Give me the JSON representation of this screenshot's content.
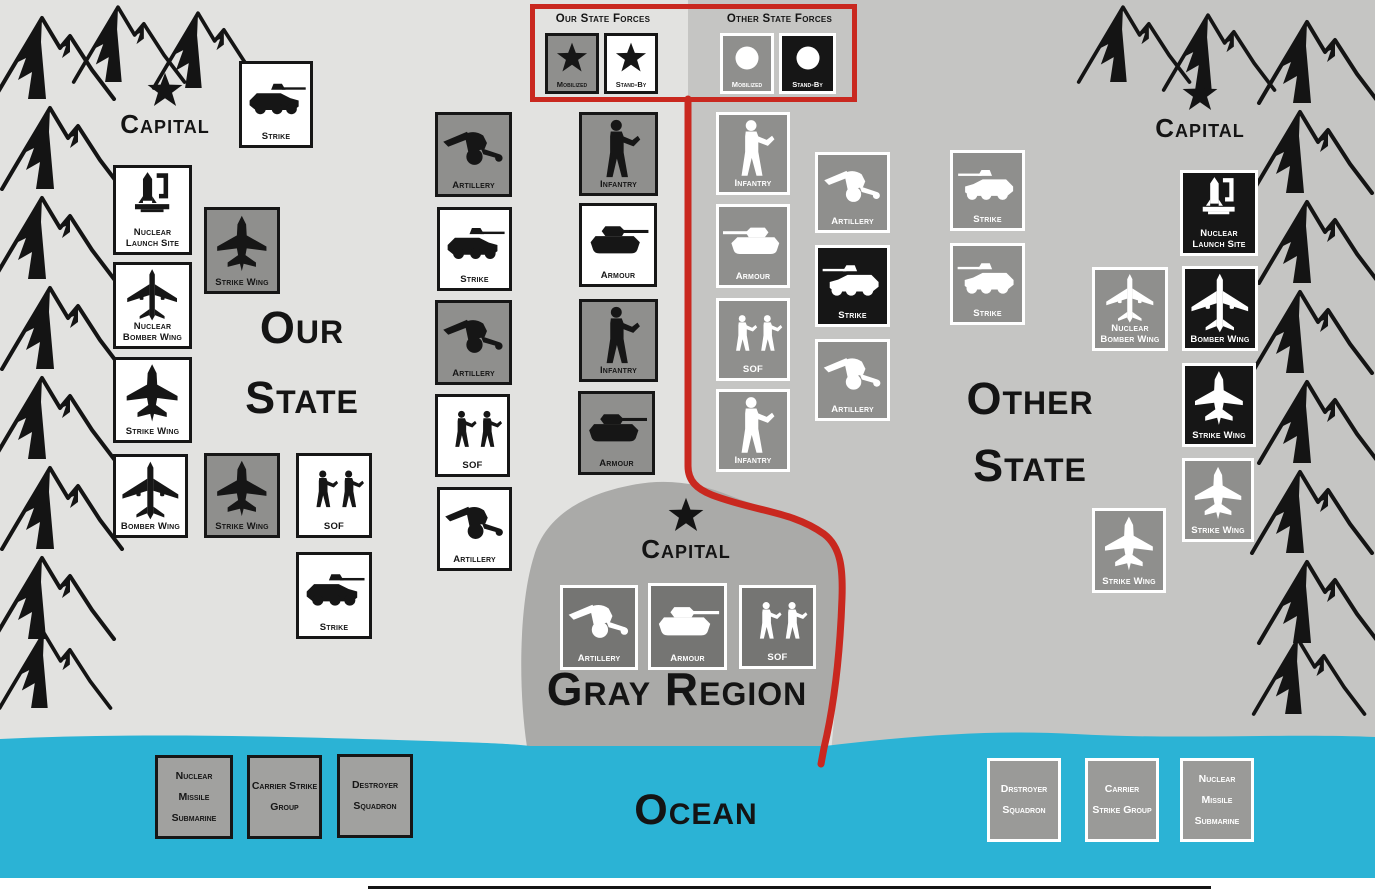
{
  "legend": {
    "our": {
      "title": "Our State Forces",
      "items": [
        {
          "label": "Mobilized"
        },
        {
          "label": "Stand-By"
        }
      ]
    },
    "other": {
      "title": "Other State Forces",
      "items": [
        {
          "label": "Mobilized"
        },
        {
          "label": "Stand-By"
        }
      ]
    }
  },
  "regions": {
    "our_state": {
      "name": "Our State",
      "capital_label": "Capital"
    },
    "other_state": {
      "name": "Other State",
      "capital_label": "Capital"
    },
    "gray_region": {
      "name": "Gray Region",
      "capital_label": "Capital"
    },
    "ocean": {
      "name": "Ocean"
    }
  },
  "colors": {
    "boundary_red": "#c9281f",
    "ocean_cyan": "#2bb3d5",
    "our_state_bg": "#e2e2e0",
    "other_state_bg": "#c5c5c3",
    "gray_region_bg": "#aaaaa8",
    "unit_gray": "#8f8f8d",
    "unit_black": "#161616",
    "unit_white": "#ffffff"
  },
  "capitals": [
    {
      "region": "our_state",
      "x": 100,
      "y": 72,
      "w": 130
    },
    {
      "region": "other_state",
      "x": 1135,
      "y": 76,
      "w": 130
    },
    {
      "region": "gray_region",
      "x": 620,
      "y": 497,
      "w": 132
    }
  ],
  "units": [
    {
      "label": "Strike",
      "icon": "strike",
      "variant": "our-standby",
      "x": 239,
      "y": 61,
      "w": 74,
      "h": 87
    },
    {
      "label": "Nuclear\nLaunch Site",
      "icon": "nuclear-launch",
      "variant": "our-standby",
      "x": 113,
      "y": 165,
      "w": 79,
      "h": 90
    },
    {
      "label": "Strike Wing",
      "icon": "strike-wing",
      "variant": "our-mobilized",
      "x": 204,
      "y": 207,
      "w": 76,
      "h": 87
    },
    {
      "label": "Nuclear\nBomber Wing",
      "icon": "bomber-wing",
      "variant": "our-standby",
      "x": 113,
      "y": 262,
      "w": 79,
      "h": 87
    },
    {
      "label": "Strike Wing",
      "icon": "strike-wing",
      "variant": "our-standby",
      "x": 113,
      "y": 357,
      "w": 79,
      "h": 86
    },
    {
      "label": "Bomber Wing",
      "icon": "bomber-wing",
      "variant": "our-standby",
      "x": 113,
      "y": 454,
      "w": 75,
      "h": 84
    },
    {
      "label": "Strike Wing",
      "icon": "strike-wing",
      "variant": "our-mobilized",
      "x": 204,
      "y": 453,
      "w": 76,
      "h": 85
    },
    {
      "label": "SOF",
      "icon": "sof",
      "variant": "our-standby",
      "x": 296,
      "y": 453,
      "w": 76,
      "h": 85
    },
    {
      "label": "Strike",
      "icon": "strike",
      "variant": "our-standby",
      "x": 296,
      "y": 552,
      "w": 76,
      "h": 87
    },
    {
      "label": "Artillery",
      "icon": "artillery",
      "variant": "our-mobilized",
      "x": 435,
      "y": 112,
      "w": 77,
      "h": 85
    },
    {
      "label": "Strike",
      "icon": "strike",
      "variant": "our-standby",
      "x": 437,
      "y": 207,
      "w": 75,
      "h": 84
    },
    {
      "label": "Artillery",
      "icon": "artillery",
      "variant": "our-mobilized",
      "x": 435,
      "y": 300,
      "w": 77,
      "h": 85
    },
    {
      "label": "SOF",
      "icon": "sof",
      "variant": "our-standby",
      "x": 435,
      "y": 394,
      "w": 75,
      "h": 83
    },
    {
      "label": "Artillery",
      "icon": "artillery",
      "variant": "our-standby",
      "x": 437,
      "y": 487,
      "w": 75,
      "h": 84
    },
    {
      "label": "Infantry",
      "icon": "infantry",
      "variant": "our-mobilized",
      "x": 579,
      "y": 112,
      "w": 79,
      "h": 84
    },
    {
      "label": "Armour",
      "icon": "armour",
      "variant": "our-standby",
      "x": 579,
      "y": 203,
      "w": 78,
      "h": 84
    },
    {
      "label": "Infantry",
      "icon": "infantry",
      "variant": "our-mobilized",
      "x": 579,
      "y": 299,
      "w": 79,
      "h": 83
    },
    {
      "label": "Armour",
      "icon": "armour",
      "variant": "our-mobilized",
      "x": 578,
      "y": 391,
      "w": 77,
      "h": 84
    },
    {
      "label": "Infantry",
      "icon": "infantry",
      "variant": "other-mobilized",
      "x": 716,
      "y": 112,
      "w": 74,
      "h": 83
    },
    {
      "label": "Armour",
      "icon": "armour",
      "variant": "other-mobilized",
      "x": 716,
      "y": 204,
      "w": 74,
      "h": 84,
      "mirror": true
    },
    {
      "label": "SOF",
      "icon": "sof",
      "variant": "other-mobilized",
      "x": 716,
      "y": 298,
      "w": 74,
      "h": 83
    },
    {
      "label": "Infantry",
      "icon": "infantry",
      "variant": "other-mobilized",
      "x": 716,
      "y": 389,
      "w": 74,
      "h": 83
    },
    {
      "label": "Artillery",
      "icon": "artillery",
      "variant": "other-mobilized",
      "x": 815,
      "y": 152,
      "w": 75,
      "h": 81
    },
    {
      "label": "Strike",
      "icon": "strike",
      "variant": "other-standby",
      "x": 815,
      "y": 245,
      "w": 75,
      "h": 82,
      "mirror": true
    },
    {
      "label": "Artillery",
      "icon": "artillery",
      "variant": "other-mobilized",
      "x": 815,
      "y": 339,
      "w": 75,
      "h": 82
    },
    {
      "label": "Strike",
      "icon": "strike",
      "variant": "other-mobilized",
      "x": 950,
      "y": 150,
      "w": 75,
      "h": 81,
      "mirror": true
    },
    {
      "label": "Strike",
      "icon": "strike",
      "variant": "other-mobilized",
      "x": 950,
      "y": 243,
      "w": 75,
      "h": 82,
      "mirror": true
    },
    {
      "label": "Nuclear\nLaunch Site",
      "icon": "nuclear-launch",
      "variant": "other-standby",
      "x": 1180,
      "y": 170,
      "w": 78,
      "h": 86
    },
    {
      "label": "Nuclear\nBomber Wing",
      "icon": "bomber-wing",
      "variant": "other-mobilized",
      "x": 1092,
      "y": 267,
      "w": 76,
      "h": 84
    },
    {
      "label": "Bomber Wing",
      "icon": "bomber-wing",
      "variant": "other-standby",
      "x": 1182,
      "y": 266,
      "w": 76,
      "h": 85
    },
    {
      "label": "Strike Wing",
      "icon": "strike-wing",
      "variant": "other-standby",
      "x": 1182,
      "y": 363,
      "w": 74,
      "h": 84
    },
    {
      "label": "Strike Wing",
      "icon": "strike-wing",
      "variant": "other-mobilized",
      "x": 1182,
      "y": 458,
      "w": 72,
      "h": 84
    },
    {
      "label": "Strike Wing",
      "icon": "strike-wing",
      "variant": "other-mobilized",
      "x": 1092,
      "y": 508,
      "w": 74,
      "h": 85
    },
    {
      "label": "Artillery",
      "icon": "artillery",
      "variant": "gray-region",
      "x": 560,
      "y": 585,
      "w": 78,
      "h": 85
    },
    {
      "label": "Armour",
      "icon": "armour",
      "variant": "gray-region",
      "x": 648,
      "y": 583,
      "w": 79,
      "h": 87
    },
    {
      "label": "SOF",
      "icon": "sof",
      "variant": "gray-region",
      "x": 739,
      "y": 585,
      "w": 77,
      "h": 84
    }
  ],
  "naval_units": [
    {
      "lines": [
        "Nuclear",
        "Missile",
        "Submarine"
      ],
      "variant": "naval-our",
      "x": 155,
      "y": 755,
      "w": 78,
      "h": 84
    },
    {
      "lines": [
        "Carrier Strike",
        "Group"
      ],
      "variant": "naval-our",
      "x": 247,
      "y": 755,
      "w": 75,
      "h": 84
    },
    {
      "lines": [
        "Destroyer",
        "Squadron"
      ],
      "variant": "naval-our",
      "x": 337,
      "y": 754,
      "w": 76,
      "h": 84
    },
    {
      "lines": [
        "Drstroyer",
        "Squadron"
      ],
      "variant": "naval-other",
      "x": 987,
      "y": 758,
      "w": 74,
      "h": 84
    },
    {
      "lines": [
        "Carrier",
        "Strike Group"
      ],
      "variant": "naval-other",
      "x": 1085,
      "y": 758,
      "w": 74,
      "h": 84
    },
    {
      "lines": [
        "Nuclear",
        "Missile",
        "Submarine"
      ],
      "variant": "naval-other",
      "x": 1180,
      "y": 758,
      "w": 74,
      "h": 84
    }
  ]
}
